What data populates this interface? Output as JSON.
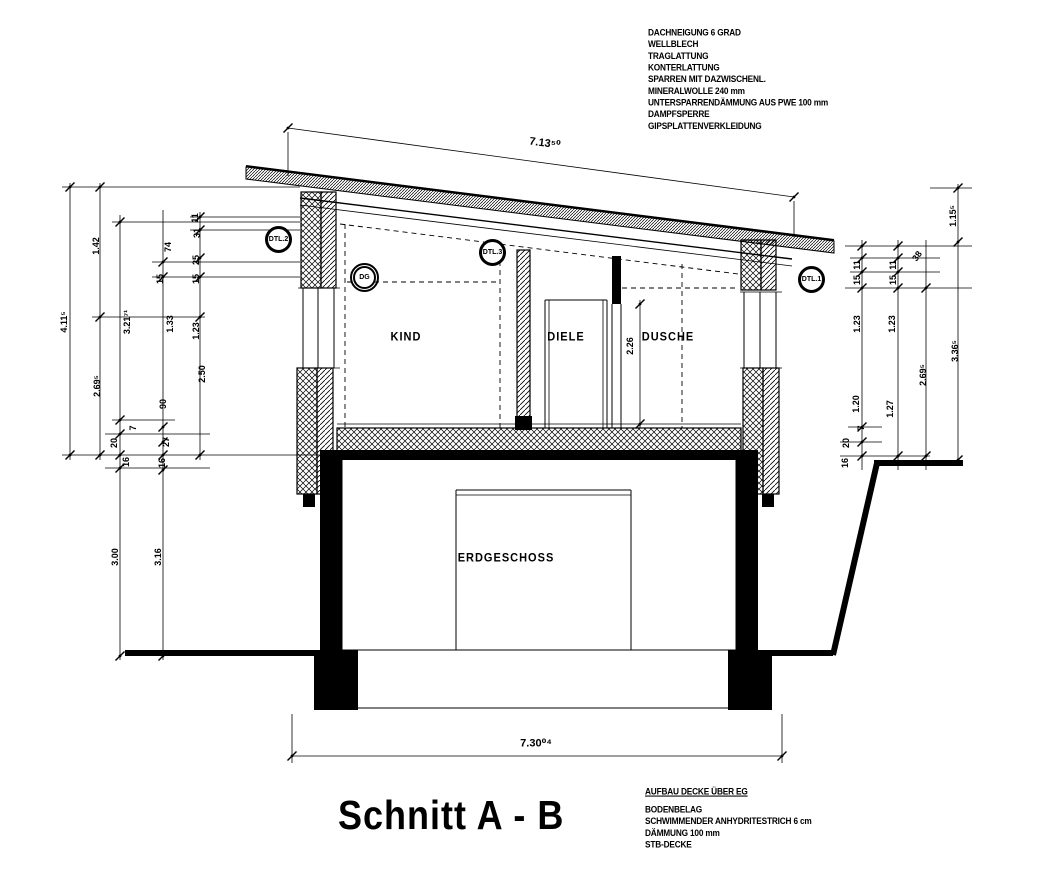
{
  "drawing": {
    "title": "Schnitt A - B",
    "colors": {
      "ink": "#000000",
      "paper": "#ffffff"
    },
    "roof_spec": {
      "lines": [
        "DACHNEIGUNG 6 GRAD",
        "WELLBLECH",
        "TRAGLATTUNG",
        "KONTERLATTUNG",
        "SPARREN MIT DAZWISCHENL.",
        "MINERALWOLLE 240 mm",
        "UNTERSPARRENDÄMMUNG AUS PWE 100 mm",
        "DAMPFSPERRE",
        "GIPSPLATTENVERKLEIDUNG"
      ]
    },
    "floor_spec": {
      "title": "AUFBAU DECKE ÜBER EG",
      "lines": [
        "BODENBELAG",
        "SCHWIMMENDER ANHYDRITESTRICH 6 cm",
        "DÄMMUNG 100 mm",
        "STB-DECKE"
      ]
    },
    "rooms": {
      "kind": "KIND",
      "diele": "DIELE",
      "dusche": "DUSCHE",
      "erdgeschoss": "ERDGESCHOSS"
    },
    "detail_markers": {
      "dtl2": "DTL.2",
      "dg": "DG",
      "dtl3": "DTL.3",
      "dtl1": "DTL.1"
    },
    "dimensions": {
      "top_total": "7.13⁵⁰",
      "bottom_total": "7.30⁰⁴",
      "left": [
        "1.42",
        "4.11⁵",
        "2.69⁵",
        "3.21⁷¹",
        "1.33",
        "1.23",
        "74",
        "11",
        "31",
        "25",
        "15",
        "15",
        "2.50",
        "90",
        "7",
        "20",
        "27",
        "16",
        "16",
        "3.00",
        "3.16"
      ],
      "right": [
        "1.15⁵",
        "11",
        "15",
        "11",
        "15",
        "38",
        "1.23",
        "1.23",
        "1.20",
        "1.27",
        "2.69⁵",
        "3.36⁵",
        "20",
        "7",
        "16"
      ],
      "interior": [
        "2.26"
      ]
    }
  }
}
